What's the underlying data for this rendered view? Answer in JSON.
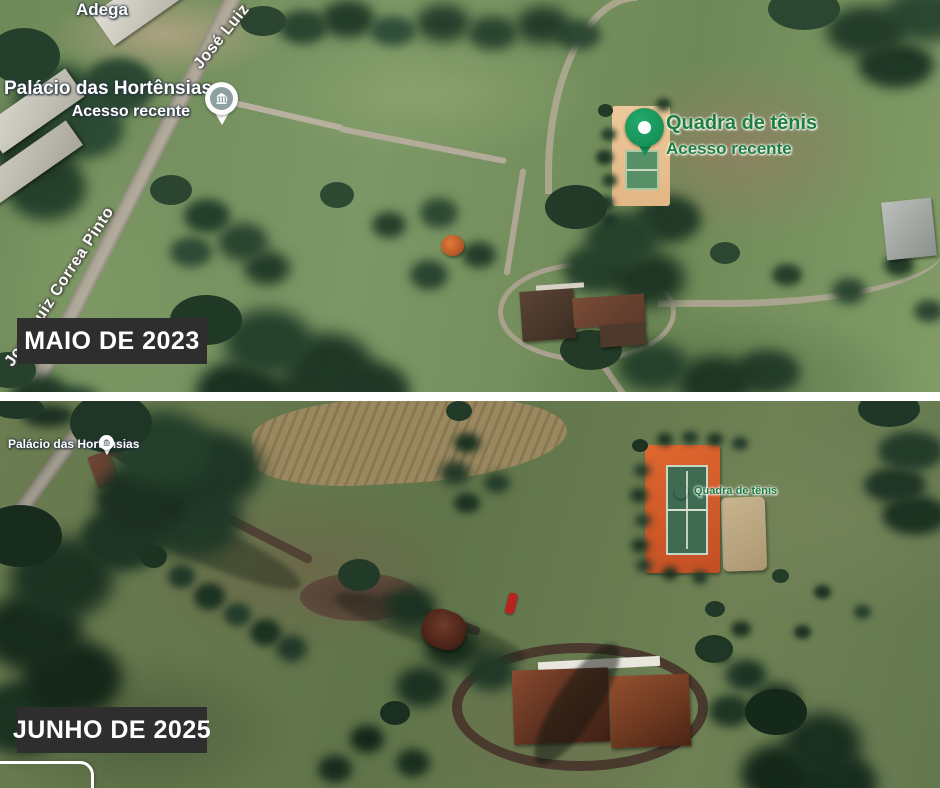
{
  "comparison": {
    "site": "Palácio das Hortênsias satellite comparison",
    "panels": [
      {
        "period_label": "MAIO DE 2023",
        "poi": {
          "adega": "Adega",
          "palacio": "Palácio das Hortênsias",
          "palacio_sub": "Acesso recente",
          "tennis": "Quadra de tênis",
          "tennis_sub": "Acesso recente"
        },
        "streets": {
          "top": "José Luiz",
          "left": "José Luiz Correa Pinto"
        }
      },
      {
        "period_label": "JUNHO DE 2025",
        "poi": {
          "palacio": "Palácio das Hortênsias",
          "tennis": "Quadra de tênis"
        }
      }
    ],
    "colors": {
      "badge_bg": "#2e2e2e",
      "badge_text": "#ffffff",
      "poi_label_green": "#1e7e3e",
      "pin_green": "#179c5f",
      "court_clay_2025": "#d2592a",
      "court_surface_2025": "#3f6b52",
      "court_sand_2023": "#ecc592"
    },
    "icons": {
      "palacio_pin": "museum-building-icon",
      "tennis_pin": "recent-access-pin-icon"
    }
  }
}
